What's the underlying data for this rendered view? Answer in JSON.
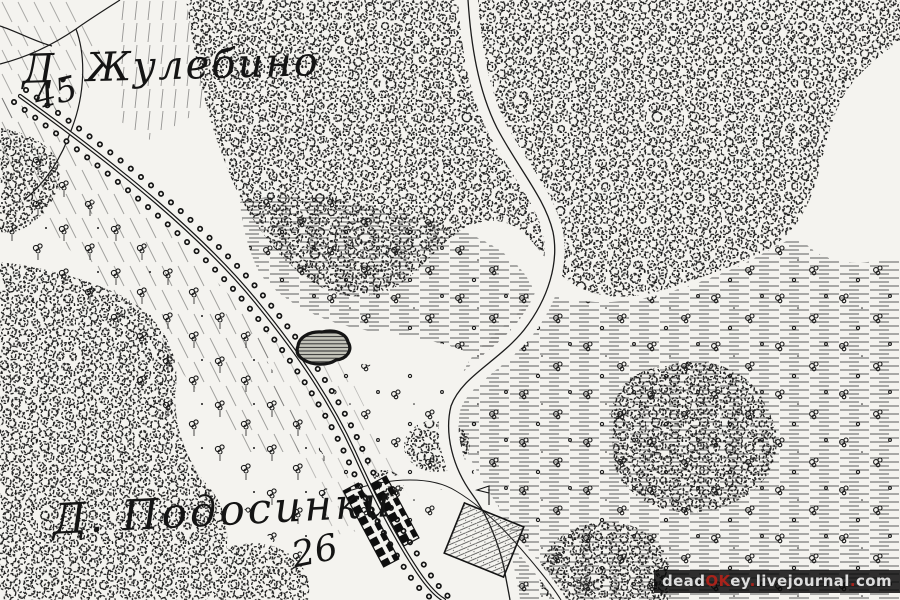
{
  "map": {
    "settlement_labels": {
      "zhulebino": {
        "name": "Д. Жулебино",
        "number": "45"
      },
      "podosinki": {
        "name": "Д. Подосинки",
        "number": "26"
      }
    },
    "features": [
      "deciduous-forest",
      "meadow-hatching",
      "scattered-trees",
      "tree-lined-road",
      "footpath",
      "stream",
      "pond",
      "village-buildings",
      "garden-plot",
      "slope-hatching",
      "flag-marker"
    ],
    "colors": {
      "paper": "#f4f3ef",
      "ink": "#1b1b1b",
      "pond_fill": "#c4c4ba"
    }
  },
  "watermark": {
    "background": "#0a0a0a",
    "light_color": "#dedede",
    "red_color": "#a8231b",
    "segments": [
      {
        "text": "dead",
        "tone": "light"
      },
      {
        "text": "OK",
        "tone": "red"
      },
      {
        "text": "ey",
        "tone": "light"
      },
      {
        "text": ".",
        "tone": "red"
      },
      {
        "text": "livejournal",
        "tone": "light"
      },
      {
        "text": ".",
        "tone": "red"
      },
      {
        "text": "com",
        "tone": "light"
      }
    ]
  }
}
